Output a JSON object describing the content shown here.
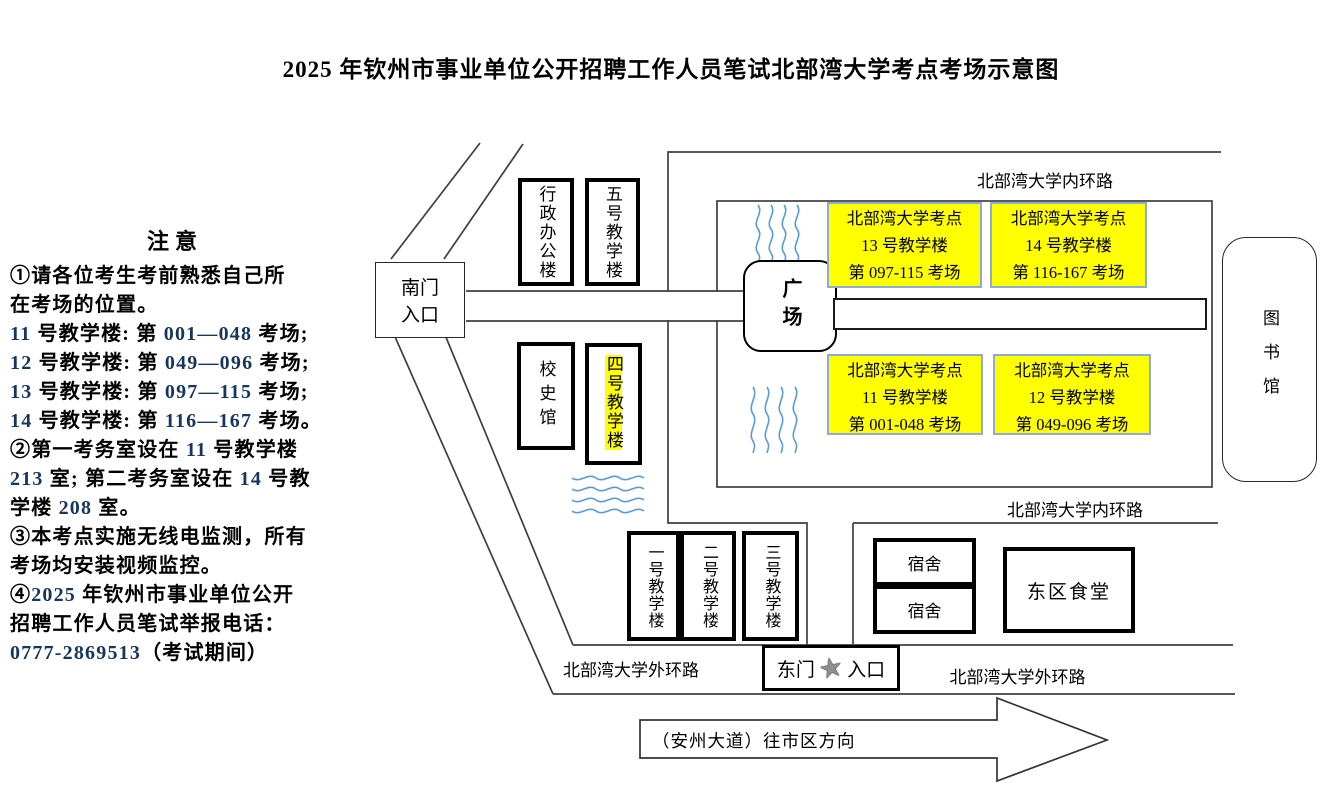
{
  "title": "2025 年钦州市事业单位公开招聘工作人员笔试北部湾大学考点考场示意图",
  "notice": {
    "heading": "注意",
    "lines": [
      [
        {
          "t": "①请各位考生考前熟悉自己所"
        }
      ],
      [
        {
          "t": "在考场的位置。"
        }
      ],
      [
        {
          "t": "11",
          "b": 1
        },
        {
          "t": " 号教学楼: 第 "
        },
        {
          "t": "001—048",
          "b": 1
        },
        {
          "t": " 考场;"
        }
      ],
      [
        {
          "t": "12",
          "b": 1
        },
        {
          "t": " 号教学楼: 第 "
        },
        {
          "t": "049—096",
          "b": 1
        },
        {
          "t": " 考场;"
        }
      ],
      [
        {
          "t": "13",
          "b": 1
        },
        {
          "t": " 号教学楼: 第 "
        },
        {
          "t": "097—115",
          "b": 1
        },
        {
          "t": " 考场;"
        }
      ],
      [
        {
          "t": "14",
          "b": 1
        },
        {
          "t": " 号教学楼: 第 "
        },
        {
          "t": "116—167",
          "b": 1
        },
        {
          "t": " 考场。"
        }
      ],
      [
        {
          "t": "②第一考务室设在 "
        },
        {
          "t": "11",
          "b": 1
        },
        {
          "t": " 号教学楼"
        }
      ],
      [
        {
          "t": "213",
          "b": 1
        },
        {
          "t": " 室; 第二考务室设在 "
        },
        {
          "t": "14",
          "b": 1
        },
        {
          "t": " 号教"
        }
      ],
      [
        {
          "t": "学楼 "
        },
        {
          "t": "208",
          "b": 1
        },
        {
          "t": " 室。"
        }
      ],
      [
        {
          "t": "③本考点实施无线电监测，所有"
        }
      ],
      [
        {
          "t": "考场均安装视频监控。"
        }
      ],
      [
        {
          "t": "④"
        },
        {
          "t": "2025",
          "b": 1
        },
        {
          "t": " 年钦州市事业单位公开"
        }
      ],
      [
        {
          "t": "招聘工作人员笔试举报电话："
        }
      ],
      [
        {
          "t": "0777-2869513",
          "b": 1
        },
        {
          "t": "（考试期间）"
        }
      ]
    ]
  },
  "map": {
    "south_gate": {
      "line1": "南门",
      "line2": "入口"
    },
    "buildings": {
      "admin": "行政办公楼",
      "no5": "五号教学楼",
      "history": "校史馆",
      "no4": "四号教学楼",
      "no1": "一号教学楼",
      "no2": "二号教学楼",
      "no3": "三号教学楼",
      "dorm1": "宿舍",
      "dorm2": "宿舍",
      "canteen": "东区食堂",
      "library": "图书馆",
      "square": "广场"
    },
    "exam_blocks": [
      {
        "l1": "北部湾大学考点",
        "l2": "13 号教学楼",
        "l3": "第 097-115 考场"
      },
      {
        "l1": "北部湾大学考点",
        "l2": "14 号教学楼",
        "l3": "第 116-167 考场"
      },
      {
        "l1": "北部湾大学考点",
        "l2": "11 号教学楼",
        "l3": "第 001-048 考场"
      },
      {
        "l1": "北部湾大学考点",
        "l2": "12 号教学楼",
        "l3": "第 049-096 考场"
      }
    ],
    "roads": {
      "inner_top": "北部湾大学内环路",
      "inner_bottom": "北部湾大学内环路",
      "outer_left": "北部湾大学外环路",
      "outer_right": "北部湾大学外环路"
    },
    "east_gate": {
      "left": "东门",
      "right": "入口",
      "star": "★"
    },
    "arrow_label": "（安州大道）往市区方向"
  },
  "colors": {
    "highlight_yellow": "#ffff00",
    "exam_border_blue": "#8eaadb",
    "number_blue": "#17365d",
    "wave_blue": "#5b9bd5"
  }
}
